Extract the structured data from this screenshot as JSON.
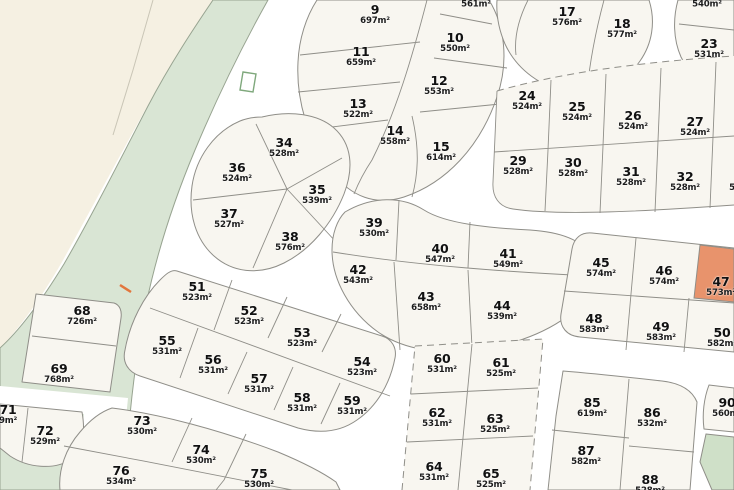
{
  "map": {
    "title": "Residential estate lot plan",
    "area_unit": "m²",
    "colors": {
      "road": "#ffffff",
      "block_fill": "#f8f6f0",
      "boundary_line": "#8f8e88",
      "cream_area": "#f5f0e2",
      "green_space": "#d9e5d4",
      "green_lot": "#cfe0c8",
      "highlight_lot": "#e8936c",
      "label_text": "#111111",
      "marker_orange": "#e2763d",
      "green_outline": "#7fa87c"
    },
    "lots": [
      {
        "number": "",
        "area": "561m²",
        "x": 476,
        "y": 5,
        "partial": true
      },
      {
        "number": "9",
        "area": "697m²",
        "x": 375,
        "y": 15
      },
      {
        "number": "10",
        "area": "550m²",
        "x": 455,
        "y": 43
      },
      {
        "number": "11",
        "area": "659m²",
        "x": 361,
        "y": 57
      },
      {
        "number": "12",
        "area": "553m²",
        "x": 439,
        "y": 86
      },
      {
        "number": "13",
        "area": "522m²",
        "x": 358,
        "y": 109
      },
      {
        "number": "14",
        "area": "558m²",
        "x": 395,
        "y": 136
      },
      {
        "number": "15",
        "area": "614m²",
        "x": 441,
        "y": 152
      },
      {
        "number": "17",
        "area": "576m²",
        "x": 567,
        "y": 17
      },
      {
        "number": "18",
        "area": "577m²",
        "x": 622,
        "y": 29
      },
      {
        "number": "",
        "area": "540m²",
        "x": 707,
        "y": 5,
        "partial": true
      },
      {
        "number": "23",
        "area": "531m²",
        "x": 709,
        "y": 49
      },
      {
        "number": "24",
        "area": "524m²",
        "x": 527,
        "y": 101
      },
      {
        "number": "25",
        "area": "524m²",
        "x": 577,
        "y": 112
      },
      {
        "number": "26",
        "area": "524m²",
        "x": 633,
        "y": 121
      },
      {
        "number": "27",
        "area": "524m²",
        "x": 695,
        "y": 127
      },
      {
        "number": "29",
        "area": "528m²",
        "x": 518,
        "y": 166
      },
      {
        "number": "30",
        "area": "528m²",
        "x": 573,
        "y": 168
      },
      {
        "number": "31",
        "area": "528m²",
        "x": 631,
        "y": 177
      },
      {
        "number": "32",
        "area": "528m²",
        "x": 685,
        "y": 182
      },
      {
        "number": "33",
        "area": "528m²",
        "x": 744,
        "y": 182,
        "partial": true
      },
      {
        "number": "34",
        "area": "528m²",
        "x": 284,
        "y": 148
      },
      {
        "number": "36",
        "area": "524m²",
        "x": 237,
        "y": 173
      },
      {
        "number": "35",
        "area": "539m²",
        "x": 317,
        "y": 195
      },
      {
        "number": "37",
        "area": "527m²",
        "x": 229,
        "y": 219
      },
      {
        "number": "38",
        "area": "576m²",
        "x": 290,
        "y": 242
      },
      {
        "number": "39",
        "area": "530m²",
        "x": 374,
        "y": 228
      },
      {
        "number": "40",
        "area": "547m²",
        "x": 440,
        "y": 254
      },
      {
        "number": "41",
        "area": "549m²",
        "x": 508,
        "y": 259
      },
      {
        "number": "42",
        "area": "543m²",
        "x": 358,
        "y": 275
      },
      {
        "number": "43",
        "area": "658m²",
        "x": 426,
        "y": 302
      },
      {
        "number": "44",
        "area": "539m²",
        "x": 502,
        "y": 311
      },
      {
        "number": "45",
        "area": "574m²",
        "x": 601,
        "y": 268
      },
      {
        "number": "46",
        "area": "574m²",
        "x": 664,
        "y": 276
      },
      {
        "number": "47",
        "area": "573m²",
        "x": 721,
        "y": 287,
        "highlighted": true,
        "partial": true
      },
      {
        "number": "48",
        "area": "583m²",
        "x": 594,
        "y": 324
      },
      {
        "number": "49",
        "area": "583m²",
        "x": 661,
        "y": 332
      },
      {
        "number": "50",
        "area": "582m²",
        "x": 722,
        "y": 338,
        "partial": true
      },
      {
        "number": "51",
        "area": "523m²",
        "x": 197,
        "y": 292
      },
      {
        "number": "52",
        "area": "523m²",
        "x": 249,
        "y": 316
      },
      {
        "number": "53",
        "area": "523m²",
        "x": 302,
        "y": 338
      },
      {
        "number": "54",
        "area": "523m²",
        "x": 362,
        "y": 367
      },
      {
        "number": "55",
        "area": "531m²",
        "x": 167,
        "y": 346
      },
      {
        "number": "56",
        "area": "531m²",
        "x": 213,
        "y": 365
      },
      {
        "number": "57",
        "area": "531m²",
        "x": 259,
        "y": 384
      },
      {
        "number": "58",
        "area": "531m²",
        "x": 302,
        "y": 403
      },
      {
        "number": "59",
        "area": "531m²",
        "x": 352,
        "y": 406
      },
      {
        "number": "68",
        "area": "726m²",
        "x": 82,
        "y": 316
      },
      {
        "number": "69",
        "area": "768m²",
        "x": 59,
        "y": 374
      },
      {
        "number": "71",
        "area": "9m²",
        "x": 8,
        "y": 415,
        "partial": true
      },
      {
        "number": "72",
        "area": "529m²",
        "x": 45,
        "y": 436
      },
      {
        "number": "73",
        "area": "530m²",
        "x": 142,
        "y": 426
      },
      {
        "number": "74",
        "area": "530m²",
        "x": 201,
        "y": 455
      },
      {
        "number": "75",
        "area": "530m²",
        "x": 259,
        "y": 479
      },
      {
        "number": "76",
        "area": "534m²",
        "x": 121,
        "y": 476
      },
      {
        "number": "60",
        "area": "531m²",
        "x": 442,
        "y": 364
      },
      {
        "number": "61",
        "area": "525m²",
        "x": 501,
        "y": 368
      },
      {
        "number": "62",
        "area": "531m²",
        "x": 437,
        "y": 418
      },
      {
        "number": "63",
        "area": "525m²",
        "x": 495,
        "y": 424
      },
      {
        "number": "64",
        "area": "531m²",
        "x": 434,
        "y": 472
      },
      {
        "number": "65",
        "area": "525m²",
        "x": 491,
        "y": 479
      },
      {
        "number": "85",
        "area": "619m²",
        "x": 592,
        "y": 408
      },
      {
        "number": "86",
        "area": "532m²",
        "x": 652,
        "y": 418
      },
      {
        "number": "87",
        "area": "582m²",
        "x": 586,
        "y": 456
      },
      {
        "number": "88",
        "area": "528m²",
        "x": 650,
        "y": 485,
        "partial": true
      },
      {
        "number": "90",
        "area": "560m²",
        "x": 727,
        "y": 408,
        "partial": true
      }
    ]
  }
}
